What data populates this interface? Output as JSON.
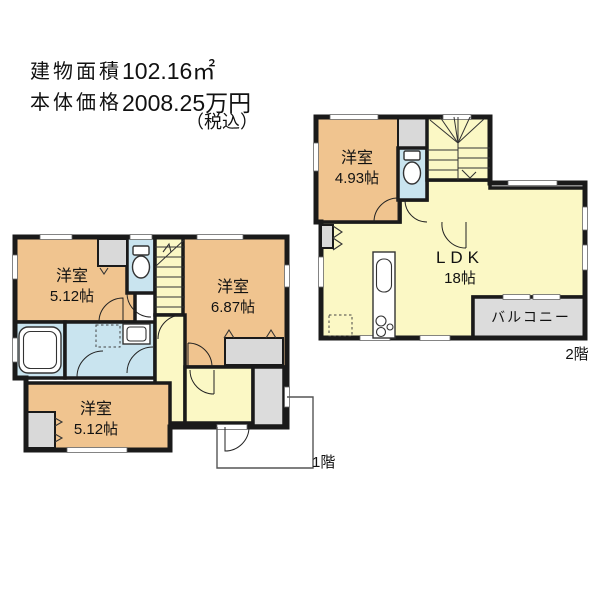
{
  "header": {
    "building_area_label": "建物面積",
    "building_area_value": "102.16㎡",
    "price_label": "本体価格",
    "price_value": "2008.25万円",
    "price_tax_note": "（税込）"
  },
  "palette": {
    "wall": "#1a1a1a",
    "room_orange": "#f0c48f",
    "living_yellow": "#fbf8c5",
    "wet_blue": "#c9e4ef",
    "closet_gray": "#d9d9d9",
    "balcony_gray": "#dcdcdc",
    "counter_cream": "#fdfbe8"
  },
  "floor1": {
    "label": "1階",
    "rooms": {
      "bedroom_nw": {
        "name": "洋室",
        "size": "5.12帖"
      },
      "bedroom_e": {
        "name": "洋室",
        "size": "6.87帖"
      },
      "bedroom_s": {
        "name": "洋室",
        "size": "5.12帖"
      }
    }
  },
  "floor2": {
    "label": "2階",
    "rooms": {
      "bedroom": {
        "name": "洋室",
        "size": "4.93帖"
      },
      "ldk": {
        "name": "LDK",
        "size": "18帖"
      },
      "balcony": {
        "name": "バルコニー"
      }
    }
  }
}
